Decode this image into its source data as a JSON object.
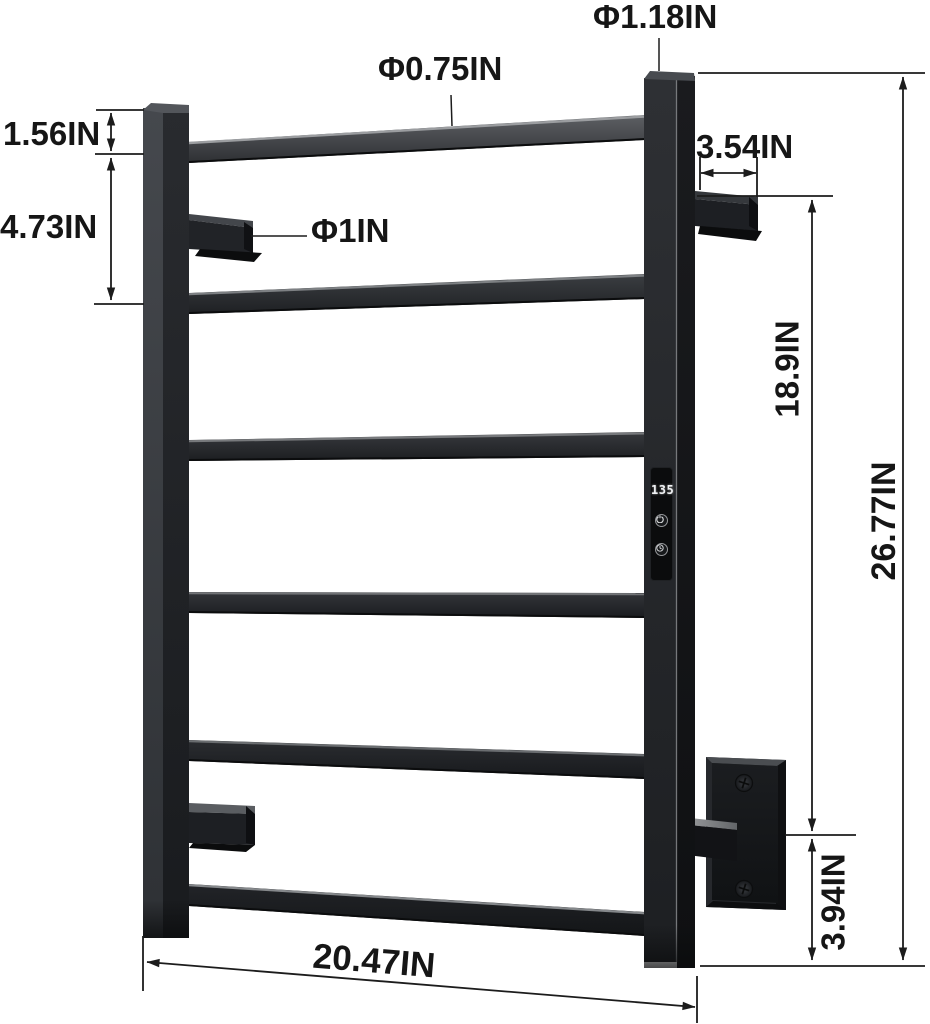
{
  "figure": {
    "kind": "product dimension diagram",
    "subject": "wall-mounted heated towel rack with 6 square rungs, LED temperature display and wall brackets",
    "background_color": "#ffffff",
    "line_color": "#1c1c1c",
    "text_color": "#161616",
    "rack_color": "#1c1e22"
  },
  "labels": {
    "post_diameter": "Φ1.18IN",
    "rung_diameter": "Φ0.75IN",
    "top_gap": "1.56IN",
    "rung_spacing": "4.73IN",
    "hook_diameter": "Φ1IN",
    "bracket_depth": "3.54IN",
    "bracket_vertical_span": "18.9IN",
    "total_height": "26.77IN",
    "bracket_to_bottom": "3.94IN",
    "overall_width": "20.47IN"
  },
  "display": {
    "reading": "135",
    "buttons": [
      "power-button",
      "timer-button"
    ],
    "digit_color": "#f0f2f4"
  }
}
